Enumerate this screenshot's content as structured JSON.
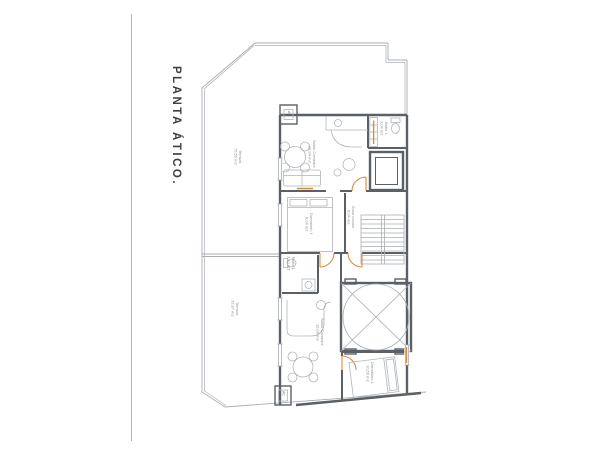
{
  "document": {
    "title": "PLANTA ÁTICO."
  },
  "plan": {
    "rooms": {
      "terraza_norte": {
        "name": "Terraza",
        "area": "76,59 m2"
      },
      "terraza_sur": {
        "name": "Terraza",
        "area": "33,87 m2"
      },
      "salon_1": {
        "name": "Salón Comedor",
        "area": "19,34 m2"
      },
      "bano_1": {
        "name": "Baño 1",
        "area": "3,04 m2"
      },
      "dormitorio_1": {
        "name": "Dormitorio 1",
        "area": "9,04 m2"
      },
      "zona_comun": {
        "name": "Zona común",
        "area": "8,04 m2"
      },
      "bano_2": {
        "name": "Baño 1",
        "area": "3,10 m2"
      },
      "salon_2": {
        "name": "Salón Comedor",
        "area": "19,06 m2"
      },
      "dormitorio_2": {
        "name": "Dormitorio 1",
        "area": "10,56 m2"
      }
    },
    "equipment": {
      "ac_1": "AC",
      "ac_2": "AC"
    },
    "colors": {
      "walls": "#5b6066",
      "thin_lines": "#a9afb5",
      "doors": "#dd8a3c",
      "labels": "#8d939b",
      "title": "#3c4043"
    }
  }
}
